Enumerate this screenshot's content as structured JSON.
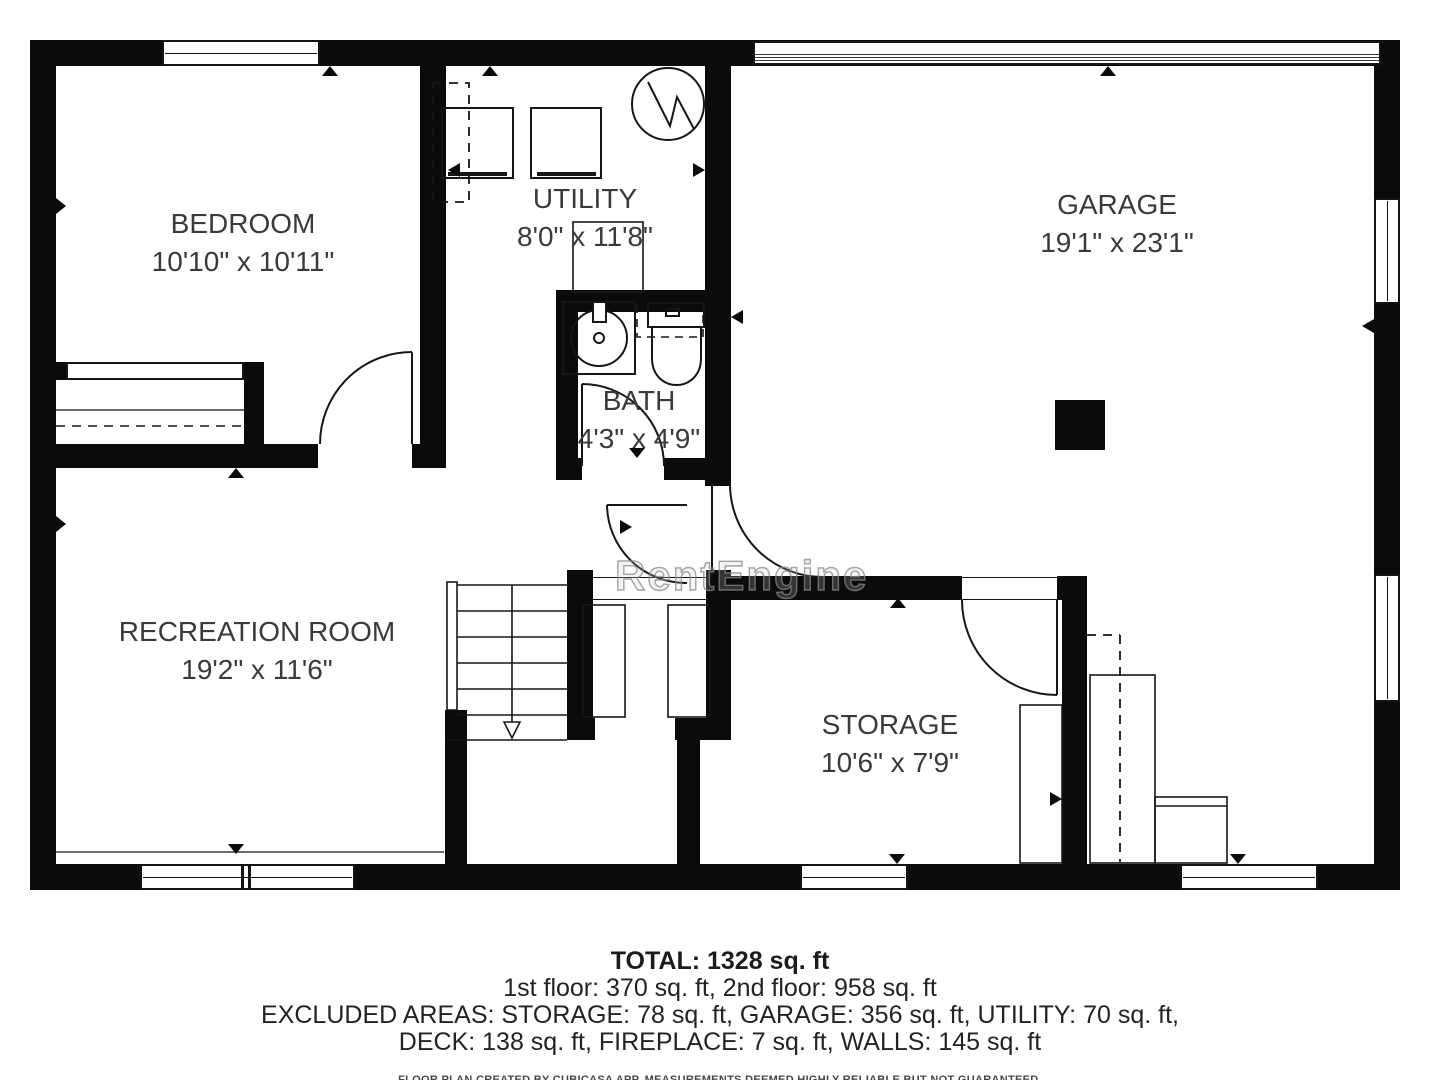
{
  "watermark": "RentEngine",
  "rooms": [
    {
      "id": "bedroom",
      "name": "BEDROOM",
      "dims": "10'10\" x 10'11\""
    },
    {
      "id": "utility",
      "name": "UTILITY",
      "dims": "8'0\" x 11'8\""
    },
    {
      "id": "garage",
      "name": "GARAGE",
      "dims": "19'1\" x 23'1\""
    },
    {
      "id": "bath",
      "name": "BATH",
      "dims": "4'3\" x 4'9\""
    },
    {
      "id": "recreation",
      "name": "RECREATION ROOM",
      "dims": "19'2\" x 11'6\""
    },
    {
      "id": "storage",
      "name": "STORAGE",
      "dims": "10'6\" x 7'9\""
    }
  ],
  "summary": {
    "total": "TOTAL: 1328 sq. ft",
    "floors": "1st floor: 370 sq. ft, 2nd floor: 958 sq. ft",
    "excluded_line1": "EXCLUDED AREAS: STORAGE: 78 sq. ft, GARAGE: 356 sq. ft, UTILITY: 70 sq. ft,",
    "excluded_line2": "DECK: 138 sq. ft, FIREPLACE: 7 sq. ft, WALLS: 145 sq. ft",
    "disclaimer": "FLOOR PLAN CREATED BY CUBICASA APP. MEASUREMENTS DEEMED HIGHLY RELIABLE BUT NOT GUARANTEED."
  },
  "colors": {
    "wall": "#0b0b0b",
    "label": "#3a3a3a",
    "watermark": "#999999"
  }
}
